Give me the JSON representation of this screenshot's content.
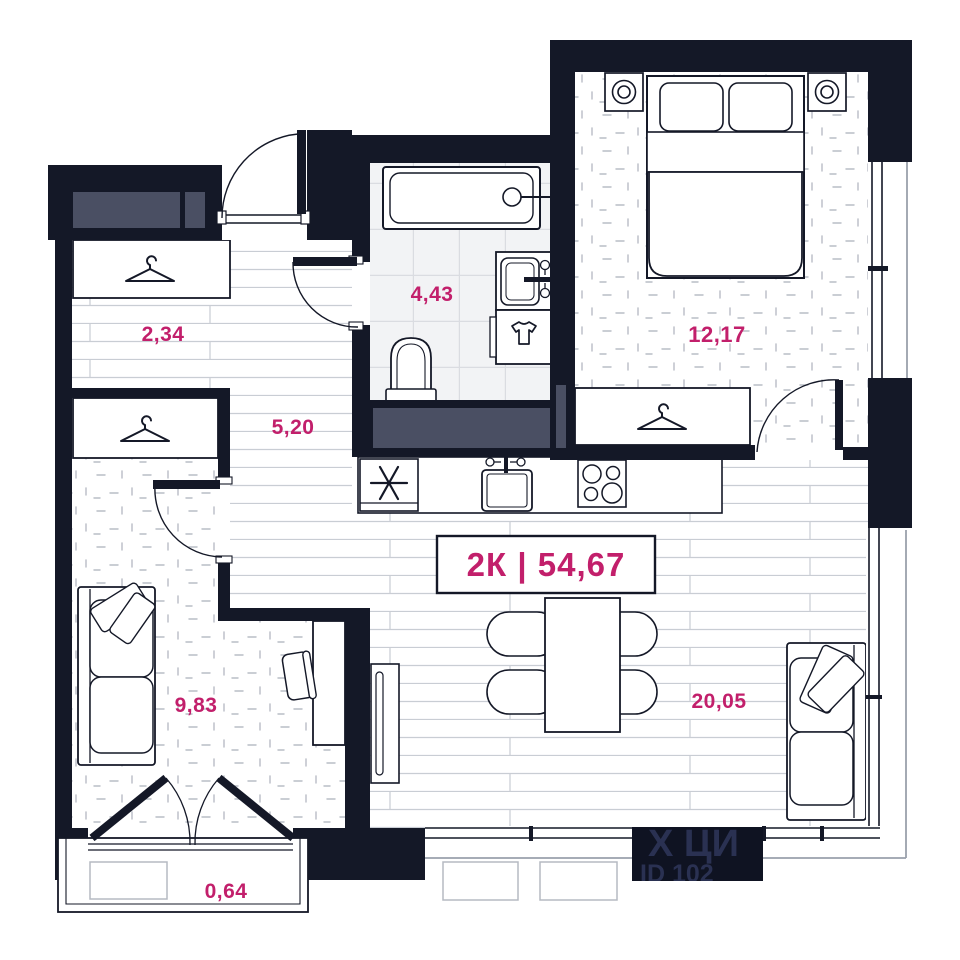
{
  "plan": {
    "title": {
      "unit_type": "2К",
      "separator": "|",
      "total_area": "54,67",
      "combined": "2К | 54,67"
    },
    "rooms": [
      {
        "id": "hall-wardrobe",
        "area": "2,34"
      },
      {
        "id": "bathroom",
        "area": "4,43"
      },
      {
        "id": "bedroom",
        "area": "12,17"
      },
      {
        "id": "hallway",
        "area": "5,20"
      },
      {
        "id": "room",
        "area": "9,83"
      },
      {
        "id": "living-kitchen",
        "area": "20,05"
      },
      {
        "id": "balcony",
        "area": "0,64"
      }
    ],
    "watermark": {
      "logo": "Х ЦИ",
      "id_text": "ID 102"
    },
    "icons": {
      "hanger": "coat-hanger-icon",
      "fridge": "snowflake-icon",
      "washer": "t-shirt-icon",
      "lamp": "double-circle-icon"
    },
    "colors": {
      "wall": "#141827",
      "accent": "#c21f6b",
      "shaft_gray": "#4a4f63",
      "floor_line": "#c9cdd4",
      "tile_line": "#dadce1",
      "facade_line": "#9aa0ab",
      "watermark_bg": "#0f1322",
      "watermark_text": "#2a3152"
    }
  }
}
